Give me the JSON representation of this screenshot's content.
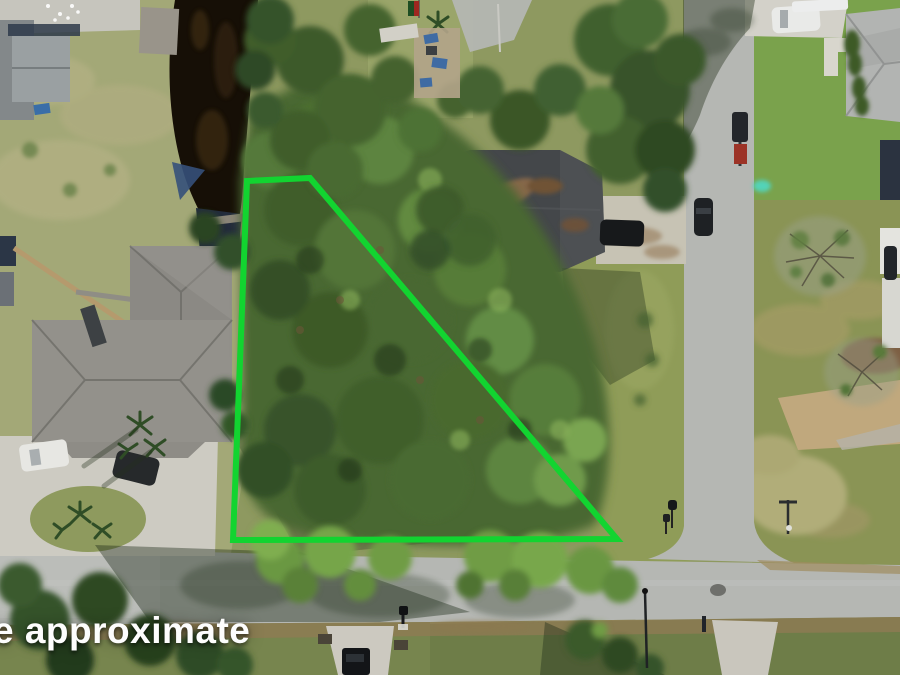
{
  "image": {
    "kind": "drone aerial photograph of a wooded residential vacant lot for sale",
    "width": 900,
    "height": 675
  },
  "watermark": {
    "text": "e approximate"
  },
  "colors": {
    "boundary": "#12d430",
    "water": "#160f06",
    "road": "#b5b7b3",
    "ground": "#8e9960",
    "concrete": "#cfcdc4",
    "canopy": "#4a6830",
    "lawn_bright": "#7aa24c",
    "lawn_olive": "#8a9455"
  },
  "boundary": {
    "shape": "quadrilateral lot outline",
    "points_str": "247,181 310,178 617,539 233,540",
    "stroke_width": 6
  },
  "scene": {
    "elements": [
      {
        "name": "subject-lot-canopy",
        "desc": "dense pine/oak canopy filling the outlined lot"
      },
      {
        "name": "canal-water",
        "desc": "dark canal inlet at upper left with docks and covered boat"
      },
      {
        "name": "left-house-roof",
        "desc": "large gray hip-roof house left of the lot"
      },
      {
        "name": "circular-driveway",
        "desc": "concrete circular drive with palm island, white car and dark car"
      },
      {
        "name": "center-house-roof",
        "desc": "dark shingle roof house at top center with pine debris"
      },
      {
        "name": "center-house-driveway",
        "desc": "concrete drive with black car"
      },
      {
        "name": "vertical-road",
        "desc": "street running top to bottom on the right"
      },
      {
        "name": "horizontal-road",
        "desc": "street running across the bottom"
      },
      {
        "name": "intersection",
        "desc": "T intersection with street sign and mailboxes"
      },
      {
        "name": "top-right-house",
        "desc": "light gray hip roof with shrub beds, white SUV and pickup in drive"
      },
      {
        "name": "truck-with-trailer",
        "desc": "dark pickup towing red mower on the road"
      },
      {
        "name": "bare-trees",
        "desc": "leafless winter trees on right-side lawns"
      },
      {
        "name": "bottom-driveways",
        "desc": "two concrete driveways south of the road, black truck at edge"
      }
    ]
  }
}
